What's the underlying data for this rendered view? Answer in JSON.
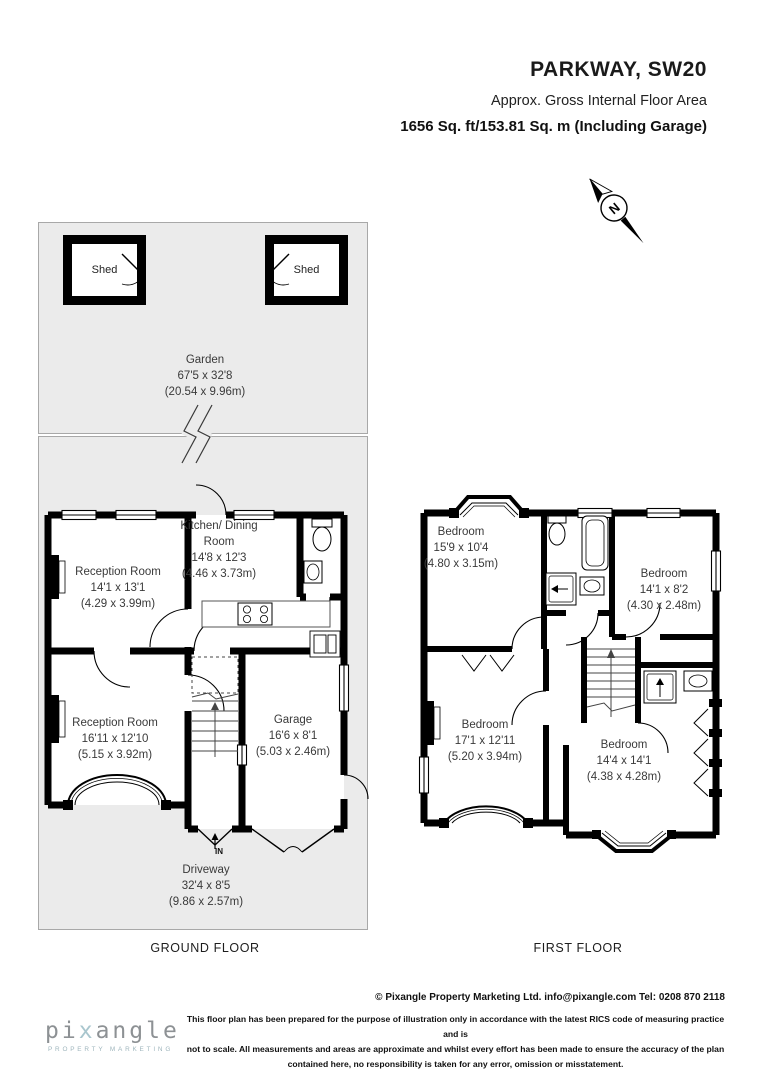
{
  "header": {
    "title": "PARKWAY, SW20",
    "subtitle": "Approx. Gross Internal Floor Area",
    "area": "1656 Sq. ft/153.81 Sq. m (Including Garage)"
  },
  "compass": {
    "label": "N"
  },
  "garden": {
    "name": "Garden",
    "dims_ft": "67'5 x 32'8",
    "dims_m": "(20.54 x 9.96m)",
    "shed_left": "Shed",
    "shed_right": "Shed"
  },
  "ground_floor": {
    "label": "GROUND FLOOR",
    "entrance": "IN",
    "reception_front": {
      "name": "Reception Room",
      "dims_ft": "14'1 x 13'1",
      "dims_m": "(4.29 x 3.99m)"
    },
    "kitchen": {
      "name": "Kitchen/ Dining Room",
      "dims_ft": "14'8 x 12'3",
      "dims_m": "(4.46 x 3.73m)"
    },
    "reception_back": {
      "name": "Reception Room",
      "dims_ft": "16'11 x 12'10",
      "dims_m": "(5.15 x 3.92m)"
    },
    "garage": {
      "name": "Garage",
      "dims_ft": "16'6 x 8'1",
      "dims_m": "(5.03 x 2.46m)"
    },
    "driveway": {
      "name": "Driveway",
      "dims_ft": "32'4 x 8'5",
      "dims_m": "(9.86 x 2.57m)"
    }
  },
  "first_floor": {
    "label": "FIRST FLOOR",
    "bedroom_1": {
      "name": "Bedroom",
      "dims_ft": "15'9 x 10'4",
      "dims_m": "(4.80 x 3.15m)"
    },
    "bedroom_2": {
      "name": "Bedroom",
      "dims_ft": "14'1 x 8'2",
      "dims_m": "(4.30 x 2.48m)"
    },
    "bedroom_3": {
      "name": "Bedroom",
      "dims_ft": "17'1 x 12'11",
      "dims_m": "(5.20 x 3.94m)"
    },
    "bedroom_4": {
      "name": "Bedroom",
      "dims_ft": "14'4 x 14'1",
      "dims_m": "(4.38 x 4.28m)"
    }
  },
  "footer": {
    "logo_pre": "pi",
    "logo_accent": "x",
    "logo_post": "angle",
    "logo_sub": "PROPERTY MARKETING",
    "copyright": "© Pixangle Property Marketing Ltd. info@pixangle.com Tel: 0208 870 2118",
    "disclaimer_lines": [
      "This floor plan has been prepared for the purpose of illustration only in accordance with the latest RICS code of measuring practice and is",
      "not to scale. All measurements and areas are approximate and whilst every effort has been made to ensure the accuracy of the plan",
      "contained here, no responsibility is taken for any error, omission or misstatement."
    ]
  },
  "colors": {
    "plan_bg": "#ebebeb",
    "wall": "#000000",
    "outline": "#a8a8a8",
    "logo_gray": "#8d9194",
    "logo_accent": "#a9c6ce"
  }
}
